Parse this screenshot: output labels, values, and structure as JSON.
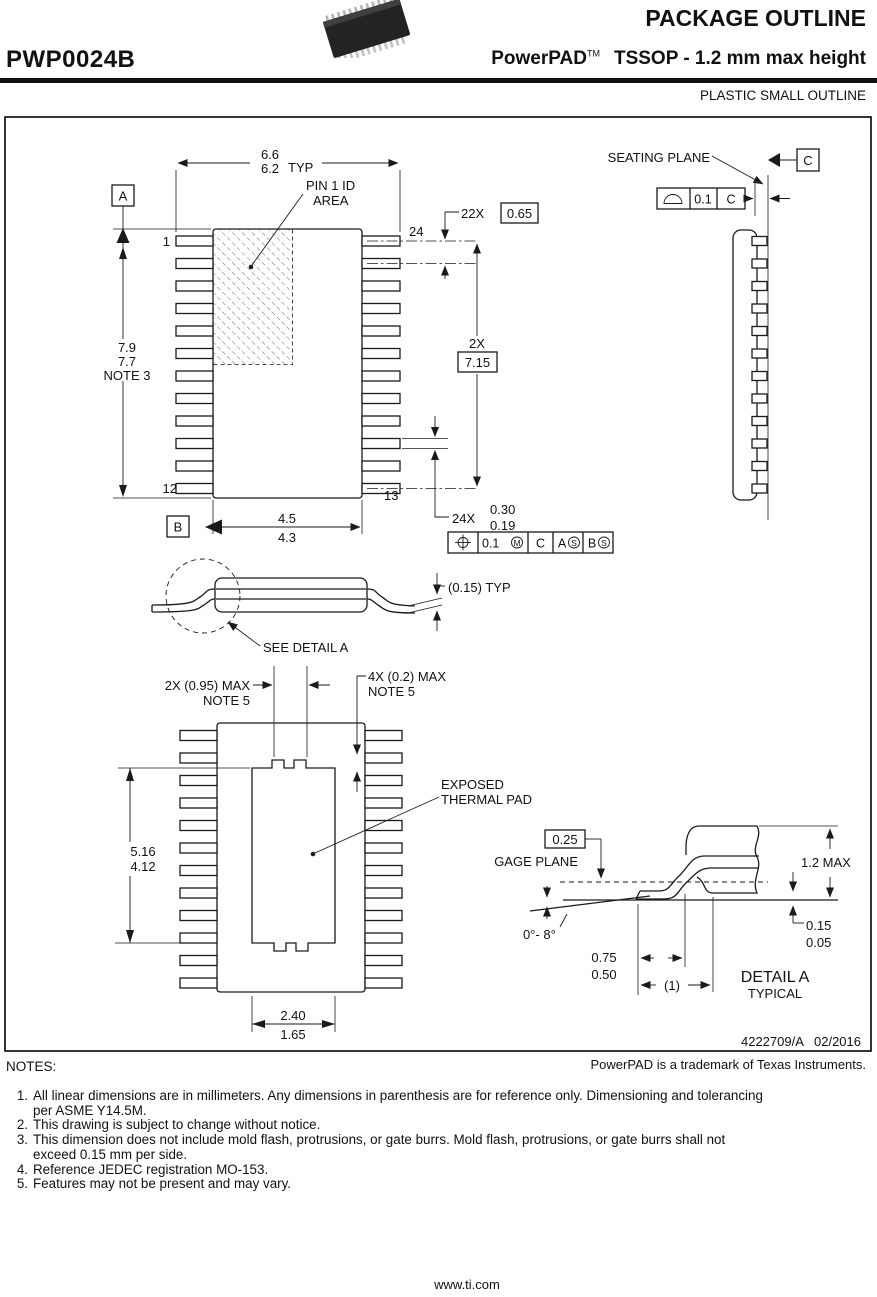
{
  "header": {
    "drawing_code": "PWP0024B",
    "title": "PACKAGE OUTLINE",
    "brand": "PowerPAD",
    "brand_tm": "TM",
    "subtitle": "TSSOP - 1.2 mm max height",
    "outline_type": "PLASTIC SMALL OUTLINE",
    "chip_icon": "tssop-package-icon"
  },
  "top_view": {
    "width_dim": {
      "v1": "6.6",
      "v2": "6.2",
      "suffix": "TYP"
    },
    "pin1_id": {
      "l1": "PIN 1 ID",
      "l2": "AREA"
    },
    "datum_a": "A",
    "datum_b": "B",
    "pin1": "1",
    "pin12": "12",
    "pin13": "13",
    "pin24": "24",
    "pitch_prefix": "22X",
    "pitch_value": "0.65",
    "length_prefix": "2X",
    "length_value": "7.15",
    "height_dim": {
      "v1": "7.9",
      "v2": "7.7",
      "note": "NOTE 3"
    },
    "body_width": {
      "v1": "4.5",
      "v2": "4.3"
    },
    "lead_width": {
      "prefix": "24X",
      "v1": "0.30",
      "v2": "0.19"
    },
    "fcf": {
      "tol": "0.1",
      "mod1": "M",
      "datum1": "C",
      "datum2": "A",
      "mod2": "S",
      "datum3": "B",
      "mod3": "S"
    }
  },
  "end_view": {
    "seating_plane": "SEATING PLANE",
    "datum_c": "C",
    "flatness": {
      "tol": "0.1",
      "datum": "C"
    }
  },
  "side_view": {
    "lead_thickness": "(0.15) TYP",
    "see_detail": "SEE DETAIL A"
  },
  "bottom_view": {
    "notch_pitch": {
      "l1": "2X (0.95) MAX",
      "l2": "NOTE 5"
    },
    "notch_depth": {
      "l1": "4X (0.2) MAX",
      "l2": "NOTE 5"
    },
    "thermal_pad": {
      "l1": "EXPOSED",
      "l2": "THERMAL PAD"
    },
    "pad_length": {
      "v1": "5.16",
      "v2": "4.12"
    },
    "pad_width": {
      "v1": "2.40",
      "v2": "1.65"
    }
  },
  "detail_a": {
    "gage_offset": "0.25",
    "gage_plane": "GAGE PLANE",
    "height": "1.2 MAX",
    "standoff": {
      "v1": "0.15",
      "v2": "0.05"
    },
    "angle": "0°- 8°",
    "foot_length": {
      "v1": "0.75",
      "v2": "0.50"
    },
    "ref_length": "(1)",
    "title": "DETAIL A",
    "subtitle": "TYPICAL"
  },
  "footer": {
    "doc_number": "4222709/A   02/2016",
    "trademark": "PowerPAD is a trademark of Texas Instruments.",
    "notes_label": "NOTES:",
    "website": "www.ti.com"
  },
  "notes": {
    "rows": [
      {
        "num": "1.",
        "text": "All linear dimensions are in millimeters. Any dimensions in parenthesis are for reference only. Dimensioning and tolerancing"
      },
      {
        "num": "",
        "text": "per ASME Y14.5M."
      },
      {
        "num": "2.",
        "text": "This drawing is subject to change without notice."
      },
      {
        "num": "3.",
        "text": "This dimension does not include mold flash, protrusions, or gate burrs. Mold flash, protrusions, or gate burrs shall not"
      },
      {
        "num": "",
        "text": "exceed 0.15 mm per side."
      },
      {
        "num": "4.",
        "text": "Reference JEDEC registration MO-153."
      },
      {
        "num": "5.",
        "text": "Features may not be present and may vary."
      }
    ]
  }
}
